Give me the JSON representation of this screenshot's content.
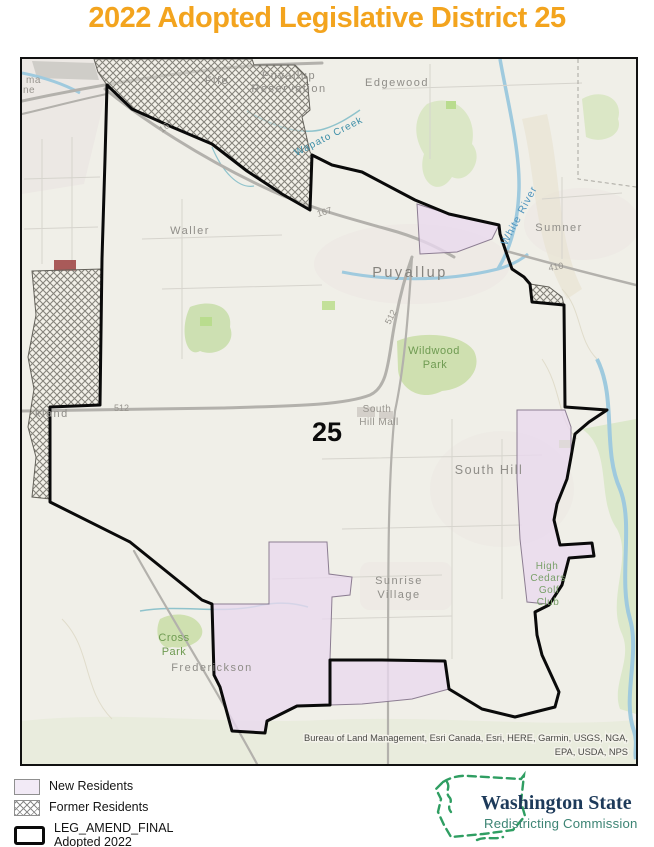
{
  "title": "2022 Adopted Legislative District 25",
  "map": {
    "district_number": "25",
    "attribution_line1": "Bureau of Land Management, Esri Canada, Esri, HERE, Garmin, USGS, NGA,",
    "attribution_line2": "EPA, USDA, NPS",
    "labels": {
      "tacoma_fragment_1": "ma",
      "tacoma_fragment_2": "ne",
      "parkland_fragment": "kland",
      "fife": "Fife",
      "puyallup_reservation_1": "Puyallup",
      "puyallup_reservation_2": "Reservation",
      "edgewood": "Edgewood",
      "waller": "Waller",
      "sumner": "Sumner",
      "puyallup": "Puyallup",
      "south_hill": "South Hill",
      "wildwood_park_1": "Wildwood",
      "wildwood_park_2": "Park",
      "south_hill_mall_1": "South",
      "south_hill_mall_2": "Hill Mall",
      "sunrise_village_1": "Sunrise",
      "sunrise_village_2": "Village",
      "cross_park_1": "Cross",
      "cross_park_2": "Park",
      "frederickson": "Frederickson",
      "high_cedars_1": "High",
      "high_cedars_2": "Cedars",
      "high_cedars_3": "Golf",
      "high_cedars_4": "Club",
      "white_river": "White River",
      "wapato_creek": "Wapato Creek"
    },
    "road_labels": {
      "hwy_167_a": "167",
      "hwy_167_b": "167",
      "hwy_512_a": "512",
      "hwy_512_b": "512",
      "hwy_410": "410"
    }
  },
  "legend": {
    "items": [
      {
        "label": "New Residents"
      },
      {
        "label": "Former Residents"
      }
    ],
    "district_layer_label_1": "LEG_AMEND_FINAL",
    "district_layer_label_2": "Adopted 2022"
  },
  "logo": {
    "org_line1": "Washington State",
    "org_line2": "Redistricting Commission"
  },
  "colors": {
    "title_orange": "#F3A41E",
    "new_residents_fill": "#F2EAF6",
    "former_residents_hatch": "#8B8B8B",
    "district_boundary": "#0A0A0A",
    "logo_green": "#2F9E62",
    "logo_navy": "#1D3A5A",
    "logo_teal": "#3D8474"
  }
}
